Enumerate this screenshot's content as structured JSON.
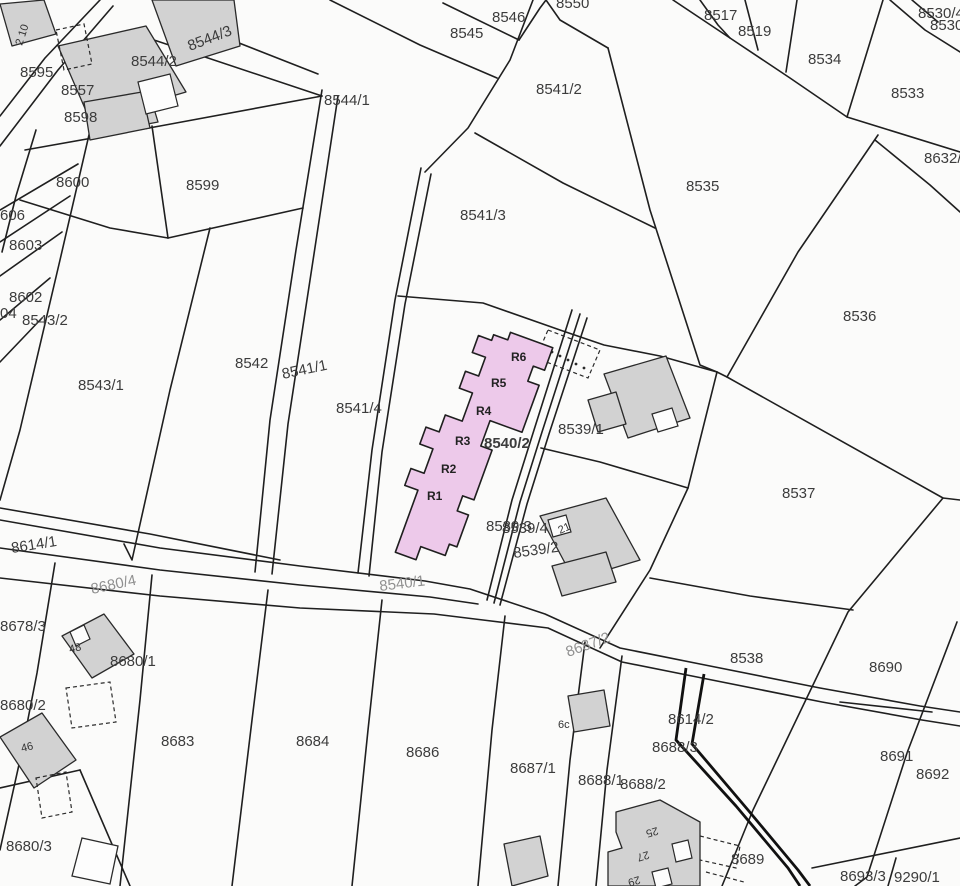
{
  "map": {
    "colors": {
      "background": "#fbfbfa",
      "line": "#1f1f1f",
      "building_fill": "#d2d2d2",
      "building_white": "#fdfdfd",
      "highlight_fill": "#edc9ea",
      "label": "#3c3c3c",
      "faint_label": "#909090"
    },
    "highlight": {
      "parcel": "8540/2",
      "units": [
        "R1",
        "R2",
        "R3",
        "R4",
        "R5",
        "R6"
      ]
    },
    "labels": [
      {
        "t": "8546"
      },
      {
        "t": "8545"
      },
      {
        "t": "8517"
      },
      {
        "t": "8519"
      },
      {
        "t": "8534"
      },
      {
        "t": "8533"
      },
      {
        "t": "8530/4"
      },
      {
        "t": "8530"
      },
      {
        "t": "8632/2"
      },
      {
        "t": "8535"
      },
      {
        "t": "8536"
      },
      {
        "t": "8537"
      },
      {
        "t": "8541/2"
      },
      {
        "t": "8541/3"
      },
      {
        "t": "8544/1"
      },
      {
        "t": "8544/2"
      },
      {
        "t": "8544/3"
      },
      {
        "t": "8595"
      },
      {
        "t": "8557"
      },
      {
        "t": "8598"
      },
      {
        "t": "8599"
      },
      {
        "t": "8600"
      },
      {
        "t": "606"
      },
      {
        "t": "8603"
      },
      {
        "t": "8602"
      },
      {
        "t": "04"
      },
      {
        "t": "8543/2"
      },
      {
        "t": "8543/1"
      },
      {
        "t": "8542"
      },
      {
        "t": "8541/1"
      },
      {
        "t": "8541/4"
      },
      {
        "t": "8539/1"
      },
      {
        "t": "8540/2"
      },
      {
        "t": "8539/3"
      },
      {
        "t": "8539/4"
      },
      {
        "t": "8539/2"
      },
      {
        "t": "8540/1"
      },
      {
        "t": "8614/1"
      },
      {
        "t": "8680/4"
      },
      {
        "t": "8678/3"
      },
      {
        "t": "8680/1"
      },
      {
        "t": "8680/2"
      },
      {
        "t": "8683"
      },
      {
        "t": "8680/3"
      },
      {
        "t": "8684"
      },
      {
        "t": "8686"
      },
      {
        "t": "8687/1"
      },
      {
        "t": "8687/2"
      },
      {
        "t": "8538"
      },
      {
        "t": "8690"
      },
      {
        "t": "8614/2"
      },
      {
        "t": "8688/3"
      },
      {
        "t": "8688/2"
      },
      {
        "t": "8688/1"
      },
      {
        "t": "8691"
      },
      {
        "t": "8692"
      },
      {
        "t": "8689"
      },
      {
        "t": "8693/3"
      },
      {
        "t": "9290/1"
      },
      {
        "t": "8550"
      }
    ],
    "units": [
      {
        "t": "R6"
      },
      {
        "t": "R5"
      },
      {
        "t": "R4"
      },
      {
        "t": "R3"
      },
      {
        "t": "R2"
      },
      {
        "t": "R1"
      }
    ],
    "house_numbers": [
      {
        "t": "2 10"
      },
      {
        "t": "48"
      },
      {
        "t": "46"
      },
      {
        "t": "21"
      },
      {
        "t": "6c"
      },
      {
        "t": "25"
      },
      {
        "t": "27"
      },
      {
        "t": "29"
      }
    ]
  }
}
